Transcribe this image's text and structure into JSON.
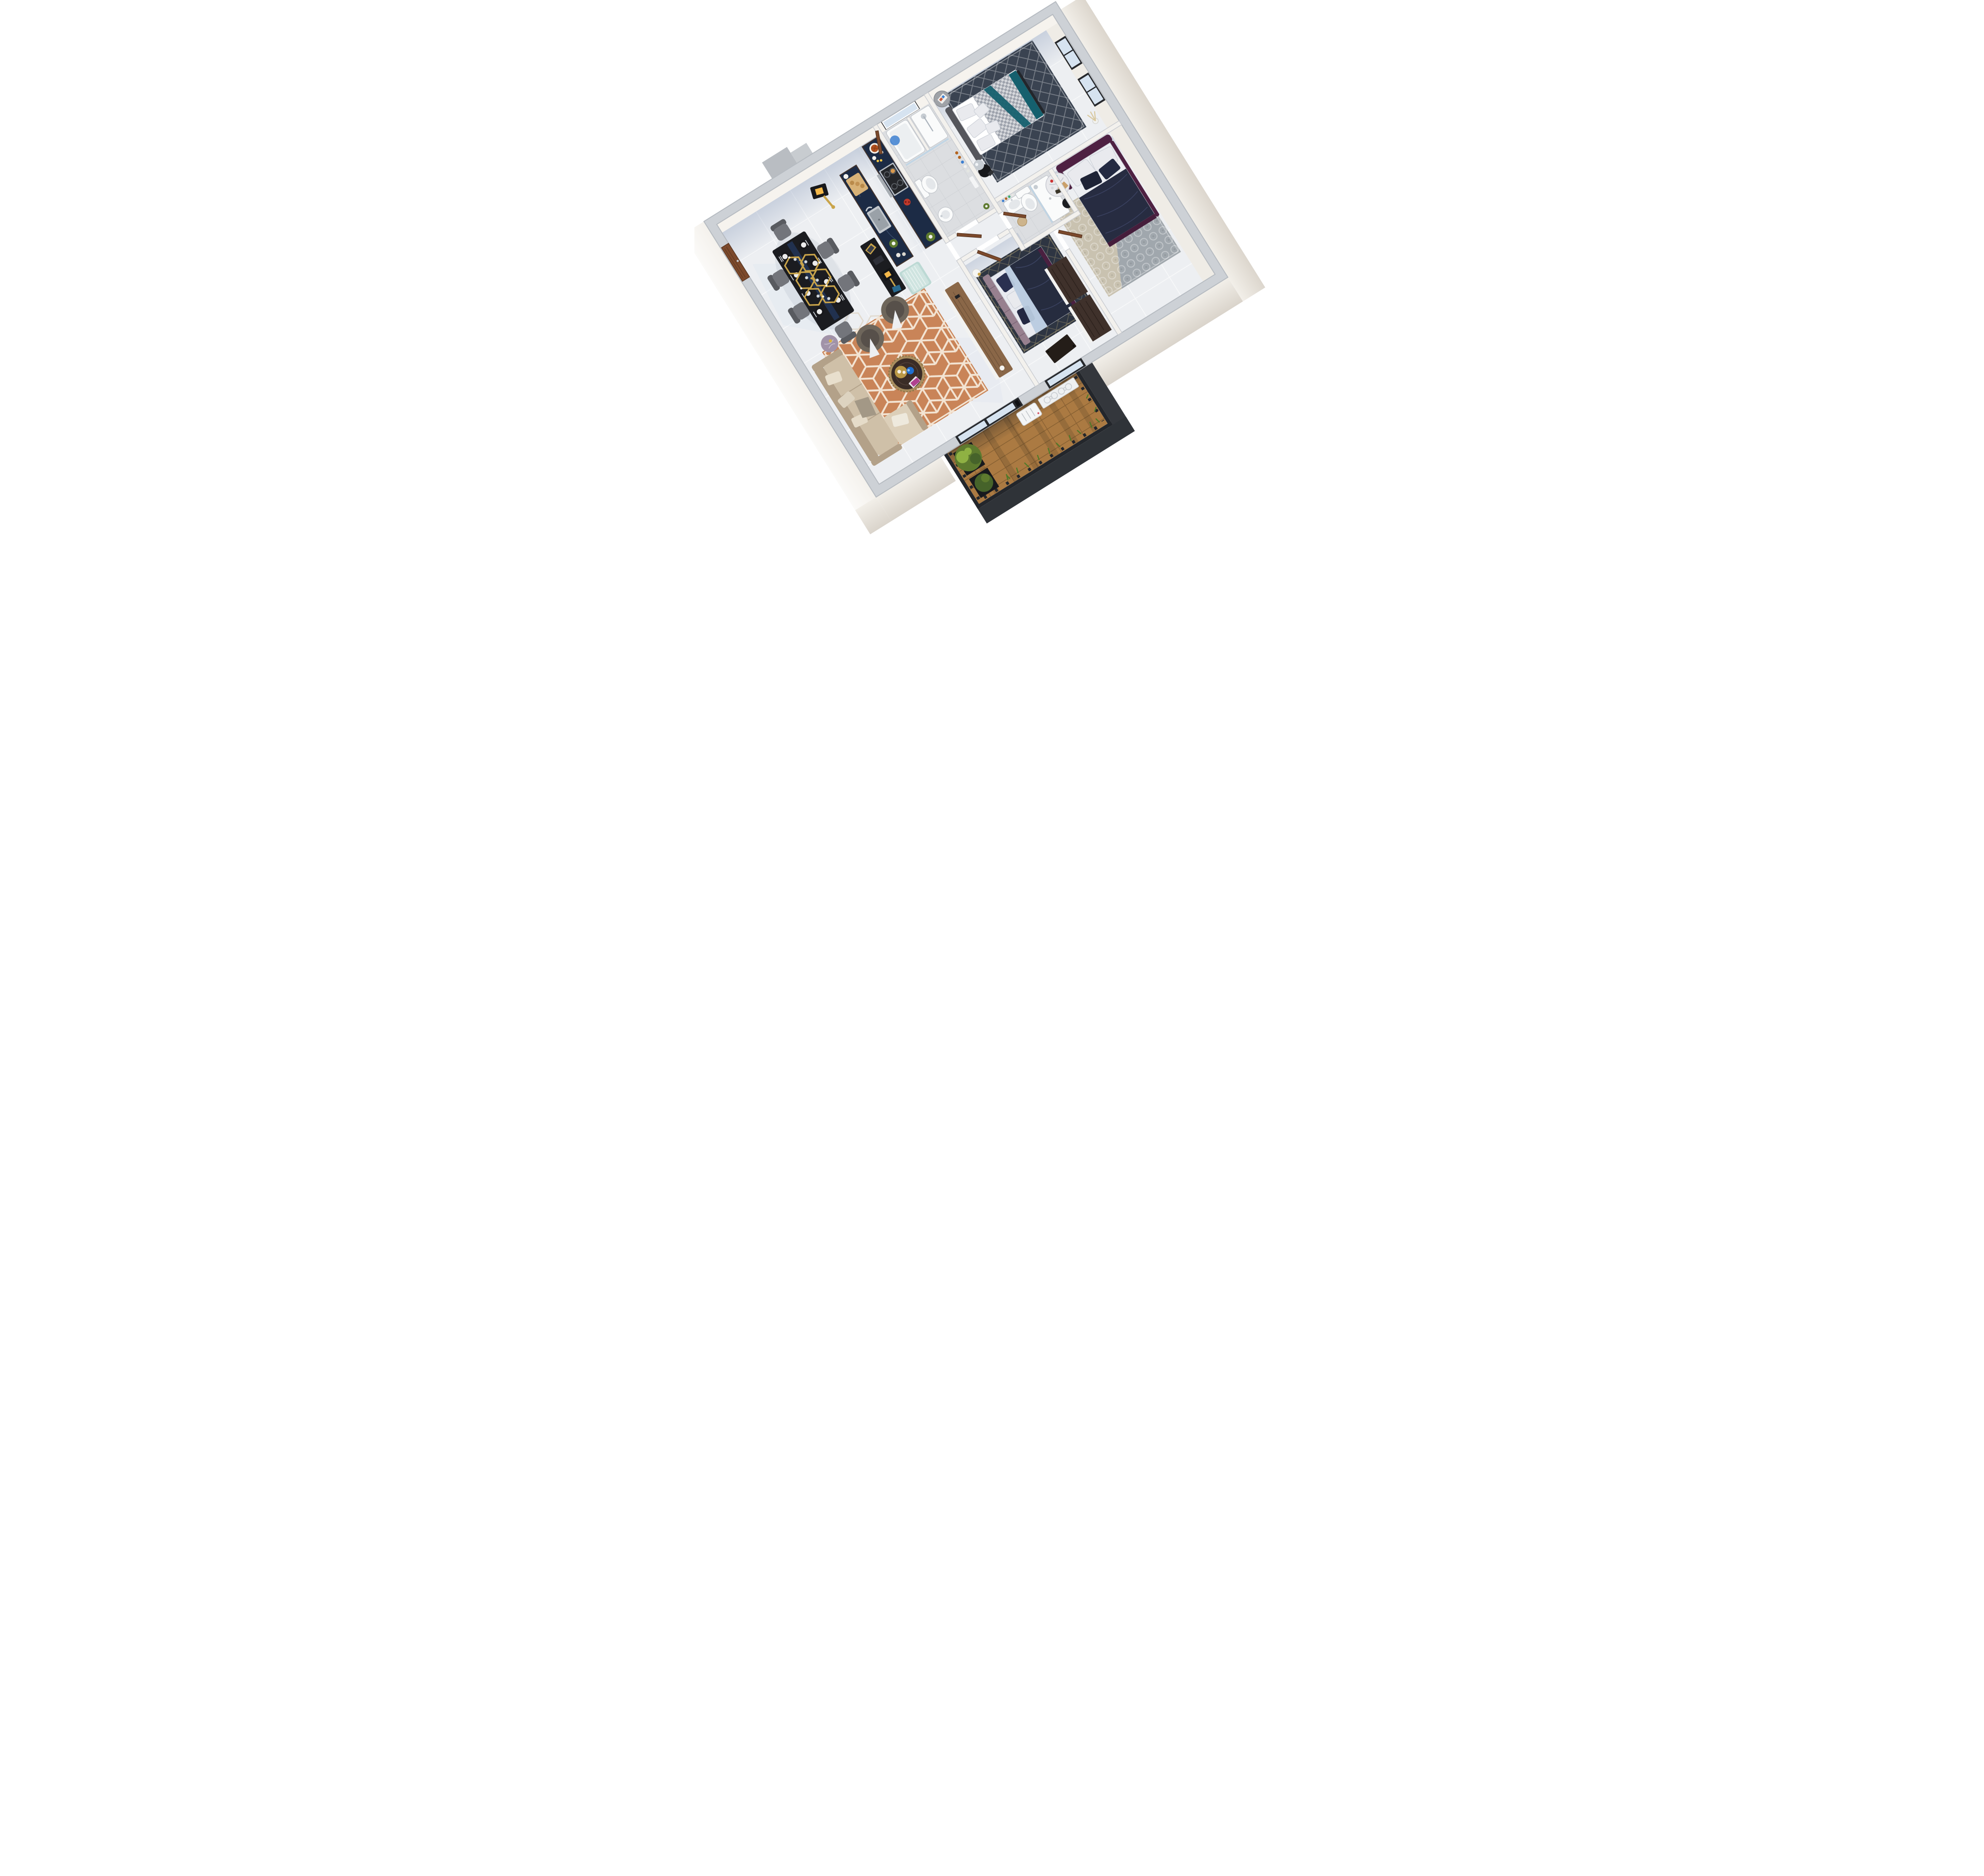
{
  "meta": {
    "title": "Isometric 3D apartment floor plan render",
    "view": "axonometric top-down, rotated",
    "background": "#ffffff"
  },
  "palette": {
    "wall-exterior-top": "#cdd1d6",
    "wall-interior-top": "#f3f1ed",
    "wall-edge": "#b6bbc1",
    "wall-face": "#f6f3ee",
    "floor-tile": "#edeff2",
    "floor-bath": "#dcdee1",
    "glass": "#d6e3f0",
    "frame-black": "#26282c",
    "chrome": "#c6ccd2",
    "fixture": "#fafbfb",
    "fixture-line": "#c3c7cc",
    "door-wood": "#7d4a2c",
    "door-wood-dark": "#5b3620",
    "counter-wood": "#43332b",
    "marble-navy": "#1c2b45",
    "steel": "#b9bfc6",
    "fridge-mint": "#bcd9d4",
    "table-black": "#1b1c20",
    "runner-navy": "#223454",
    "chair-gray": "#73757b",
    "chair-gray-dark": "#595b60",
    "gold": "#c9a44a",
    "sofa-beige": "#cfc0a8",
    "sofa-beige-light": "#dccfb9",
    "sofa-dark": "#b3a189",
    "armchair-taupe": "#6e665b",
    "armchair-seat": "#57504a",
    "rug-terracotta": "#cf8a5c",
    "rug-terracotta-line": "#f3e4d3",
    "coffee-wood": "#3a2c26",
    "coffee-gold": "#a98e5f",
    "bowl-blue": "#1f6fd0",
    "console-wood": "#8a6748",
    "console-white": "#f2f2f0",
    "marble-side": "#a193a8",
    "master-headboard": "#55565c",
    "bedding-white": "#e9eaee",
    "houndstooth-light": "#d6d8dc",
    "houndstooth-dark": "#9da2ac",
    "teal": "#15606e",
    "rug-navy": "#3a4351",
    "nightstand": "#17181b",
    "b2-plum": "#4e2142",
    "b2-navy": "#272c41",
    "b2-rug": "#c9c2b0",
    "b2-rug-blue": "#96a0ad",
    "marble-white": "#e9e9ec",
    "candle-red": "#cc3333",
    "candle-teal": "#2ab6c9",
    "b3-mauve": "#97808f",
    "b3-navy": "#262c3f",
    "b3-sheet": "#b9cbdf",
    "b3-rug": "#2e3542",
    "wardrobe-wood": "#3f312b",
    "bottle-amber": "#b4641e",
    "bottle-blue": "#3d7fd0",
    "deck-wood": "#ab7a42",
    "deck-line": "#7e5a2e",
    "fence": "#23262b",
    "balcony-face": "#34373c",
    "plant": "#5d7a2e",
    "plant-dark": "#46632a",
    "plant-light": "#8fb143",
    "lattice": "#eef0f1",
    "ac-white": "#f4f5f6",
    "landing-gray": "#b9bdc2",
    "grass": "#4e7a28"
  },
  "scene": {
    "rooms": [
      {
        "name": "living-dining-kitchen",
        "objects": [
          "entry-door",
          "dining-table",
          "dining-chairs-x6",
          "hexagon-chandelier",
          "gold-floor-lamp",
          "console-desk",
          "kitchen-island",
          "kitchen-sink",
          "gas-hob",
          "back-counter",
          "refrigerator-mint",
          "l-shaped-sofa",
          "armchair-x2",
          "round-coffee-table",
          "geometric-terracotta-rug",
          "tv-console",
          "marble-side-table"
        ]
      },
      {
        "name": "master-bedroom",
        "objects": [
          "double-bed",
          "houndstooth-duvet",
          "teal-throw",
          "navy-diamond-rug",
          "black-nightstand",
          "chrome-sphere-lamp",
          "gray-side-table",
          "window-x2",
          "pampas-vase"
        ]
      },
      {
        "name": "bathroom-1",
        "objects": [
          "bathtub",
          "shower-column",
          "glass-screen",
          "toilet",
          "pedestal-sink",
          "toiletry-bottles",
          "window"
        ]
      },
      {
        "name": "bathroom-2",
        "objects": [
          "vanity-sink",
          "toilet",
          "shower-tray",
          "glass-panel",
          "basket"
        ]
      },
      {
        "name": "bedroom-2",
        "objects": [
          "plum-velvet-bed",
          "navy-duvet",
          "patterned-beige-rug",
          "round-marble-table",
          "candles",
          "black-stool"
        ]
      },
      {
        "name": "bedroom-3",
        "objects": [
          "mauve-panel-bed",
          "navy-duvet",
          "light-blue-sheet",
          "dark-diamond-rug",
          "white-pendant-lamp",
          "wardrobe-x2",
          "dark-desk"
        ]
      },
      {
        "name": "hallway",
        "objects": [
          "wooden-door-x4"
        ]
      },
      {
        "name": "balcony",
        "objects": [
          "wood-deck",
          "black-railing",
          "planter-shrubs",
          "grass-tufts",
          "white-lattice-screen",
          "ac-unit",
          "sliding-glass-door"
        ]
      }
    ]
  }
}
